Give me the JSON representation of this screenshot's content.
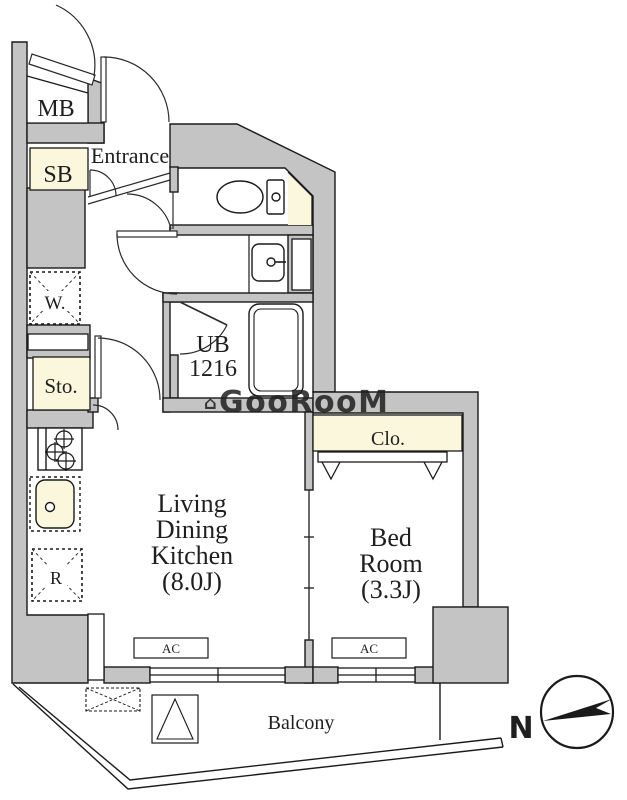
{
  "title": "apartment-floorplan",
  "colors": {
    "wall_gray": "#c4c4c4",
    "cream": "#fbf7dd",
    "line": "#1a1a1a",
    "watermark": "#d4d4d4"
  },
  "rooms": {
    "mb": {
      "label": "MB"
    },
    "sb": {
      "label": "SB"
    },
    "entrance": {
      "label": "Entrance"
    },
    "ub": {
      "line1": "UB",
      "line2": "1216"
    },
    "washer": {
      "label": "W."
    },
    "storage": {
      "label": "Sto."
    },
    "fridge": {
      "label": "R"
    },
    "ldk": {
      "line1": "Living",
      "line2": "Dining",
      "line3": "Kitchen",
      "line4": "(8.0J)"
    },
    "bedroom": {
      "line1": "Bed",
      "line2": "Room",
      "line3": "(3.3J)"
    },
    "closet": {
      "label": "Clo."
    },
    "balcony": {
      "label": "Balcony"
    }
  },
  "equipment": {
    "ac": "AC"
  },
  "compass": {
    "north": "N"
  },
  "watermark": {
    "glyph": "⌂",
    "text": "GooRooM"
  }
}
